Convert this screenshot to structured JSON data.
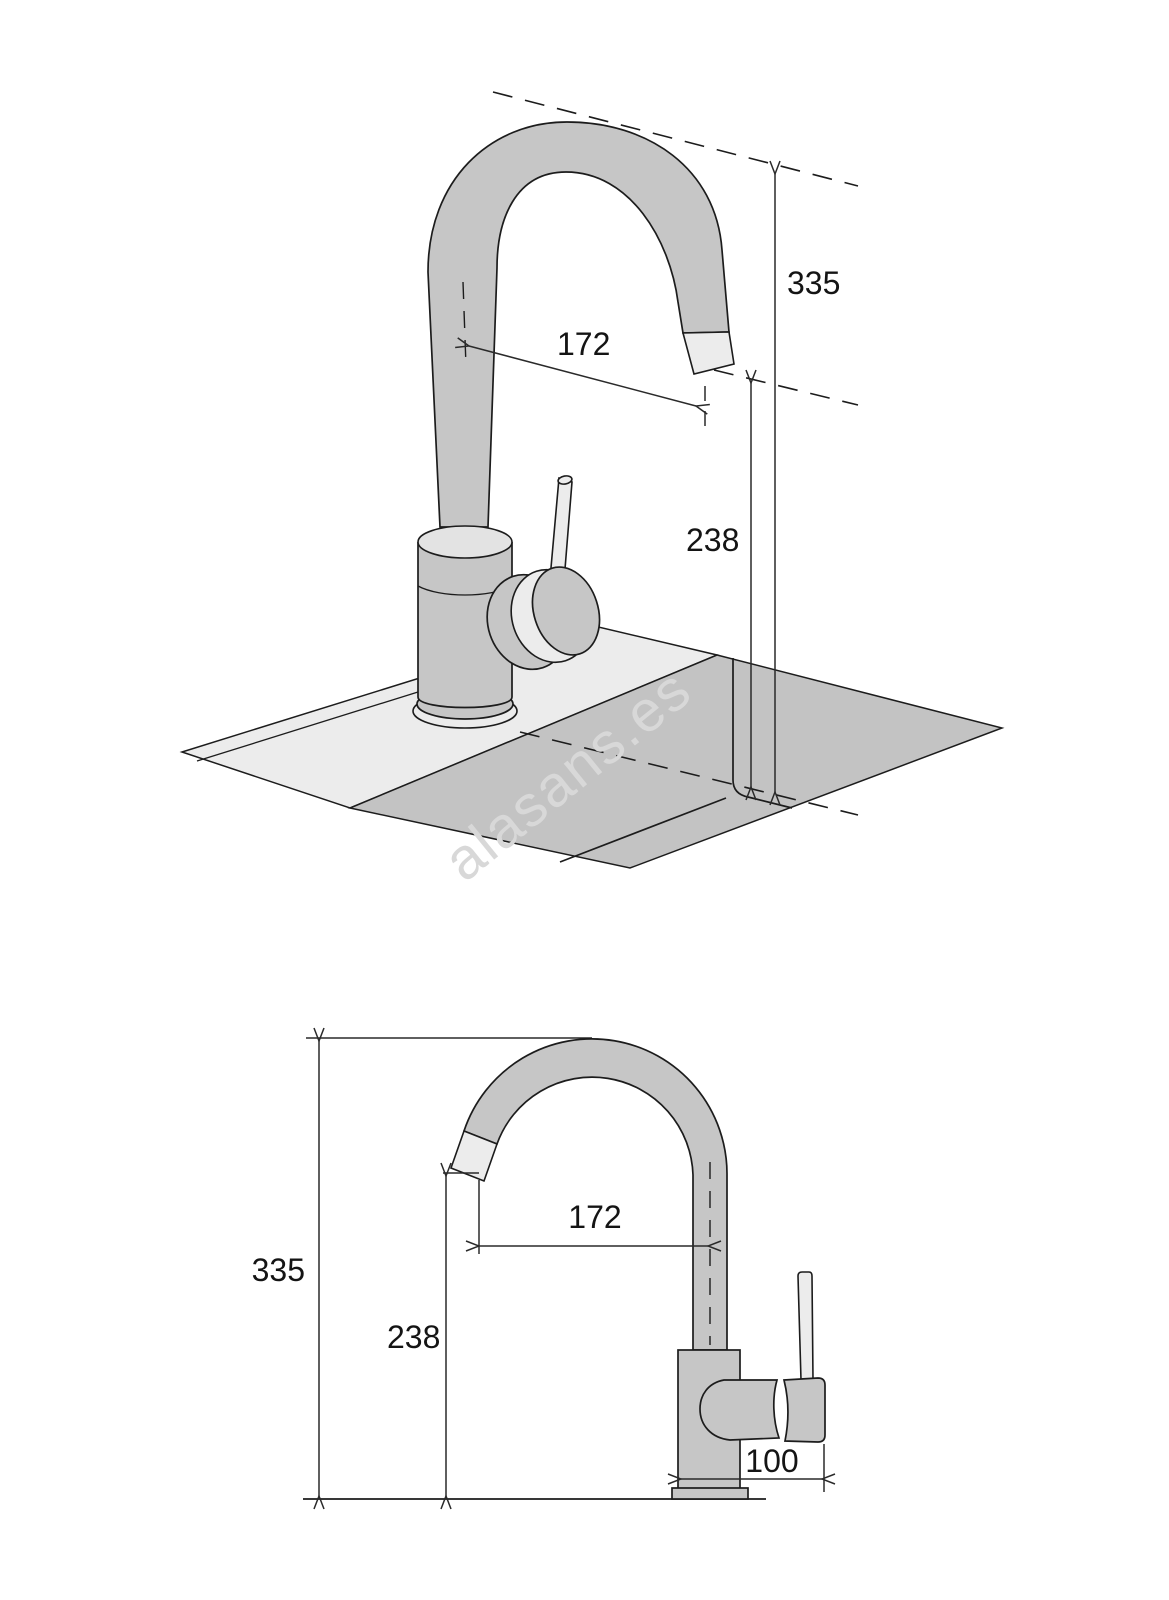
{
  "watermark": {
    "text": "alasans.es"
  },
  "colors": {
    "metal": "#c6c6c6",
    "metal_light": "#ececec",
    "counter_light": "#ececec",
    "counter_dark": "#c3c3c3",
    "outline": "#1c1c1c",
    "dimension_line": "#2a2a2a",
    "watermark": "#d8d8d8"
  },
  "figures": {
    "perspective": {
      "labels": {
        "total_height": "335",
        "spout_reach": "172",
        "spout_height": "238"
      }
    },
    "elevation": {
      "labels": {
        "total_height": "335",
        "spout_reach": "172",
        "spout_height": "238",
        "base_depth": "100"
      }
    }
  }
}
